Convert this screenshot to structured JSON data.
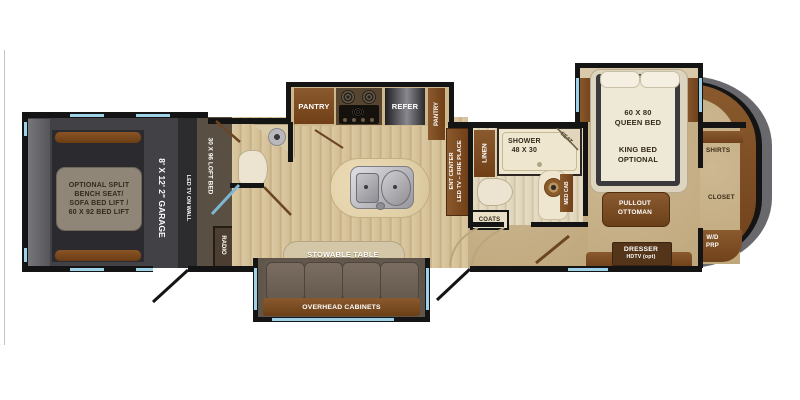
{
  "colors": {
    "wall": "#141414",
    "window_blue": "#9fd1e8",
    "wood_floor": "#d7c5a0",
    "garage_floor": "#424246",
    "loft_brown": "#5a4f43",
    "carpet": "#c8b28b",
    "cabinet_brown": "#7d4f24",
    "front_cap_gray": "#69696d"
  },
  "garage": {
    "bench_line1": "OPTIONAL SPLIT",
    "bench_line2": "BENCH SEAT/",
    "bench_line3": "SOFA BED LIFT /",
    "bench_line4": "60 X 92 BED LIFT",
    "size_label": "8' X 12' 2\" GARAGE",
    "led_tv_label": "LED TV ON WALL",
    "loft_label": "30 X 96 LOFT BED",
    "radio_label": "RADIO"
  },
  "kitchen": {
    "pantry_label": "PANTRY",
    "refer_label": "REFER",
    "pantry2_label": "PANTRY",
    "ent_line1": "ENT CENTER",
    "ent_line2": "LED TV – FIRE PLACE",
    "stowable_table_label": "STOWABLE TABLE",
    "overhead_label": "OVERHEAD CABINETS"
  },
  "bath": {
    "linen_label": "LINEN",
    "shower_line1": "SHOWER",
    "shower_line2": "48 X 30",
    "seat_label": "SEAT",
    "med_cab_label": "MED CAB",
    "coats_label": "COATS"
  },
  "bedroom": {
    "queen_line1": "60 X 80",
    "queen_line2": "QUEEN BED",
    "king_line1": "KING BED",
    "king_line2": "OPTIONAL",
    "ottoman_line1": "PULLOUT",
    "ottoman_line2": "OTTOMAN",
    "dresser_line1": "DRESSER",
    "dresser_line2": "HDTV (opt)"
  },
  "closet": {
    "shirts_label": "SHIRTS",
    "closet_label": "CLOSET",
    "wd_line1": "W/D",
    "wd_line2": "PRP"
  }
}
